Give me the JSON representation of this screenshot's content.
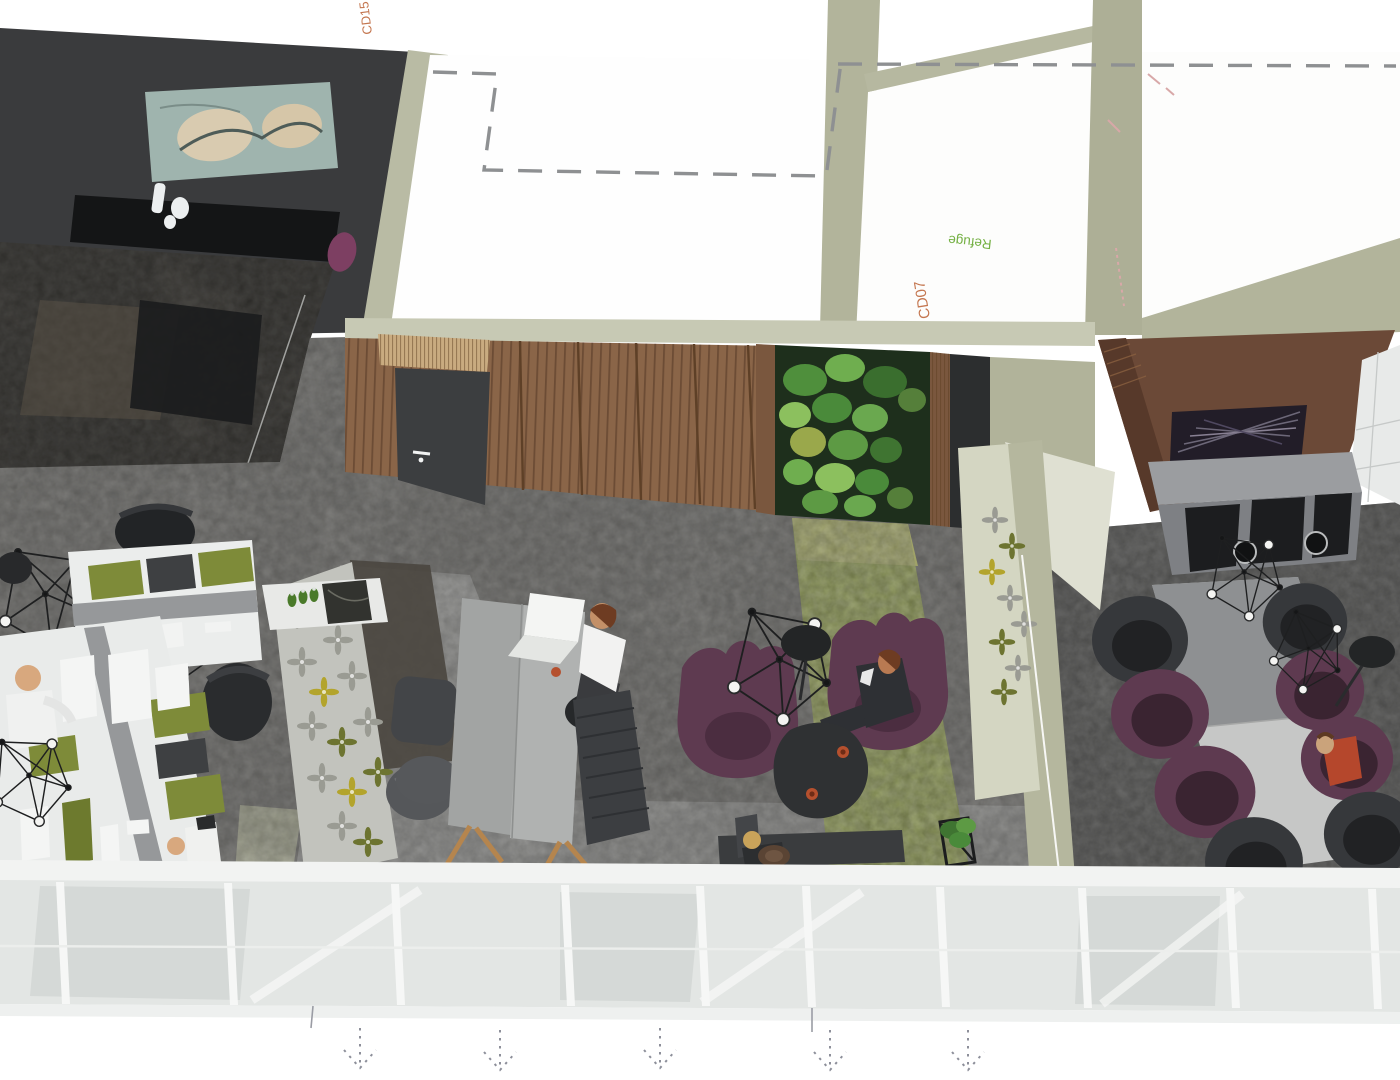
{
  "scene": {
    "title": "Office interior 3D aerial rendering",
    "view": "axonometric cutaway of an open-plan office",
    "labels": {
      "room_code_top": "CD15",
      "room_code_refuge": "CD07",
      "refuge_room": "Refuge"
    },
    "label_colors": {
      "room_code": "#c4764f",
      "refuge": "#74b043",
      "dimension_marks": "#d8a8a8"
    },
    "annotations": {
      "dashed_outline": "hidden ceiling / bulkhead outline",
      "flow_arrows_count": 5
    },
    "areas": {
      "executive_office": "dark private office with abstract artwork",
      "open_workstations": "white bench desks with monitors and task chairs",
      "touchdown_table": "standing-height table with laptop",
      "lounge": "two purple wing chairs with coffee table",
      "meeting_room": "long table with eight tub chairs and TV media wall",
      "refuge_room": "Refuge",
      "green_wall": "living plant wall",
      "glass_facade": "floor-to-ceiling glazing"
    },
    "people_count": 6,
    "colors": {
      "background": "#ffffff",
      "wall_sage": "#b2b49b",
      "wall_sage_light": "#c7c9b4",
      "wall_dark": "#3a3b3d",
      "wood_wall": "#8a6548",
      "media_wall": "#6b4937",
      "carpet_main": "#8f8e8a",
      "carpet_meeting": "#6d6d6b",
      "carpet_green": "#8e9a52",
      "tile_light": "#b6b6b3",
      "chair_purple": "#5e3a50",
      "chair_dark": "#36383b",
      "desk_white": "#ebedec",
      "accent_green": "#7e8b39",
      "glass": "#e3e6e4",
      "tv_screen": "#221d28"
    }
  }
}
